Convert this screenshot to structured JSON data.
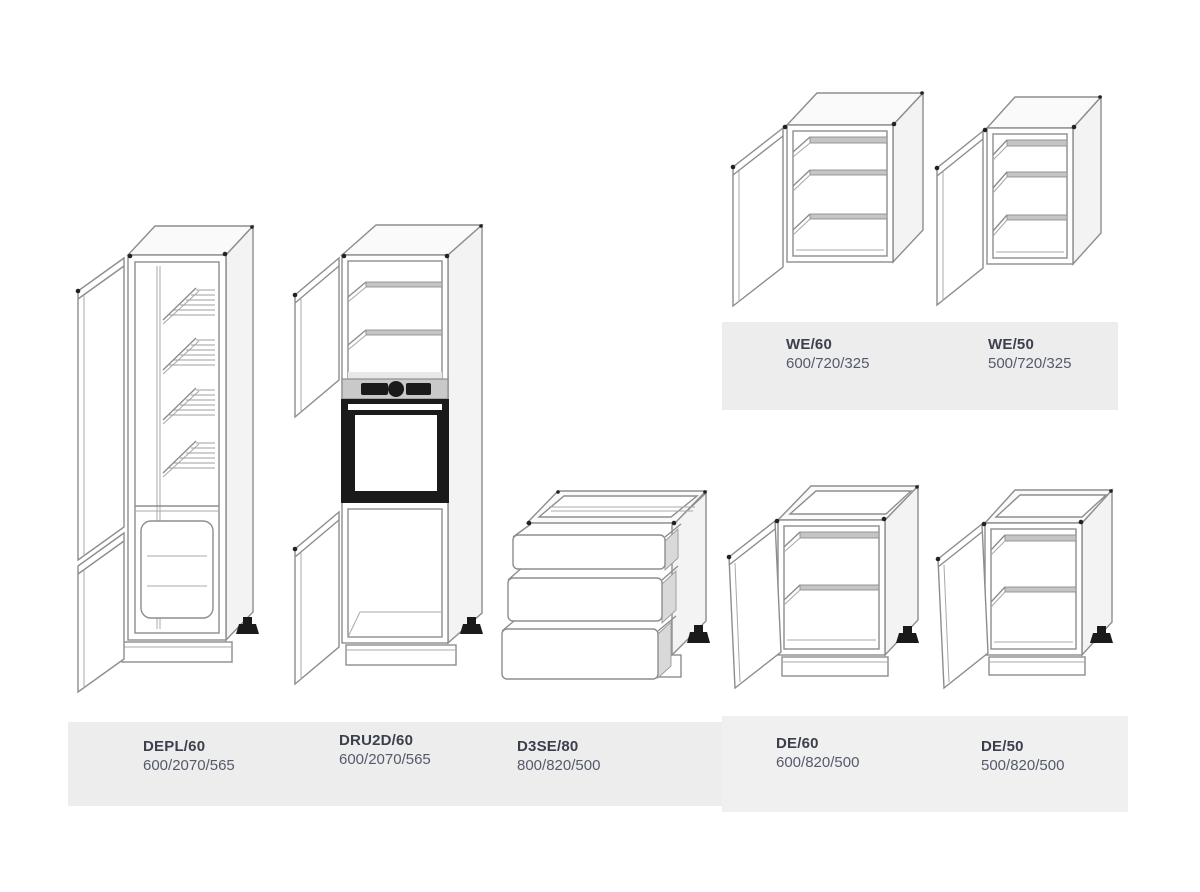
{
  "colors": {
    "background": "#ffffff",
    "label_band": "#ededed",
    "label_band_alt": "#f0f0f0",
    "product_code_text": "#3c3f4c",
    "dimensions_text": "#555a6b",
    "line_art": "#8d8d8d",
    "appliance_black": "#1a1a1a"
  },
  "wall_cabinets_section": {
    "items": [
      {
        "code": "WE/60",
        "dimensions": "600/720/325",
        "drawing": "wall-cabinet-two-shelves-open-door"
      },
      {
        "code": "WE/50",
        "dimensions": "500/720/325",
        "drawing": "wall-cabinet-two-shelves-open-door"
      }
    ]
  },
  "tall_and_base_cabinets_section": {
    "items": [
      {
        "code": "DEPL/60",
        "dimensions": "600/2070/565",
        "drawing": "tall-fridge-housing-cabinet-open-doors"
      },
      {
        "code": "DRU2D/60",
        "dimensions": "600/2070/565",
        "drawing": "tall-oven-housing-cabinet-open-doors"
      },
      {
        "code": "D3SE/80",
        "dimensions": "800/820/500",
        "drawing": "base-cabinet-three-open-drawers"
      },
      {
        "code": "DE/60",
        "dimensions": "600/820/500",
        "drawing": "base-cabinet-one-shelf-open-door"
      },
      {
        "code": "DE/50",
        "dimensions": "500/820/500",
        "drawing": "base-cabinet-one-shelf-open-door"
      }
    ]
  }
}
